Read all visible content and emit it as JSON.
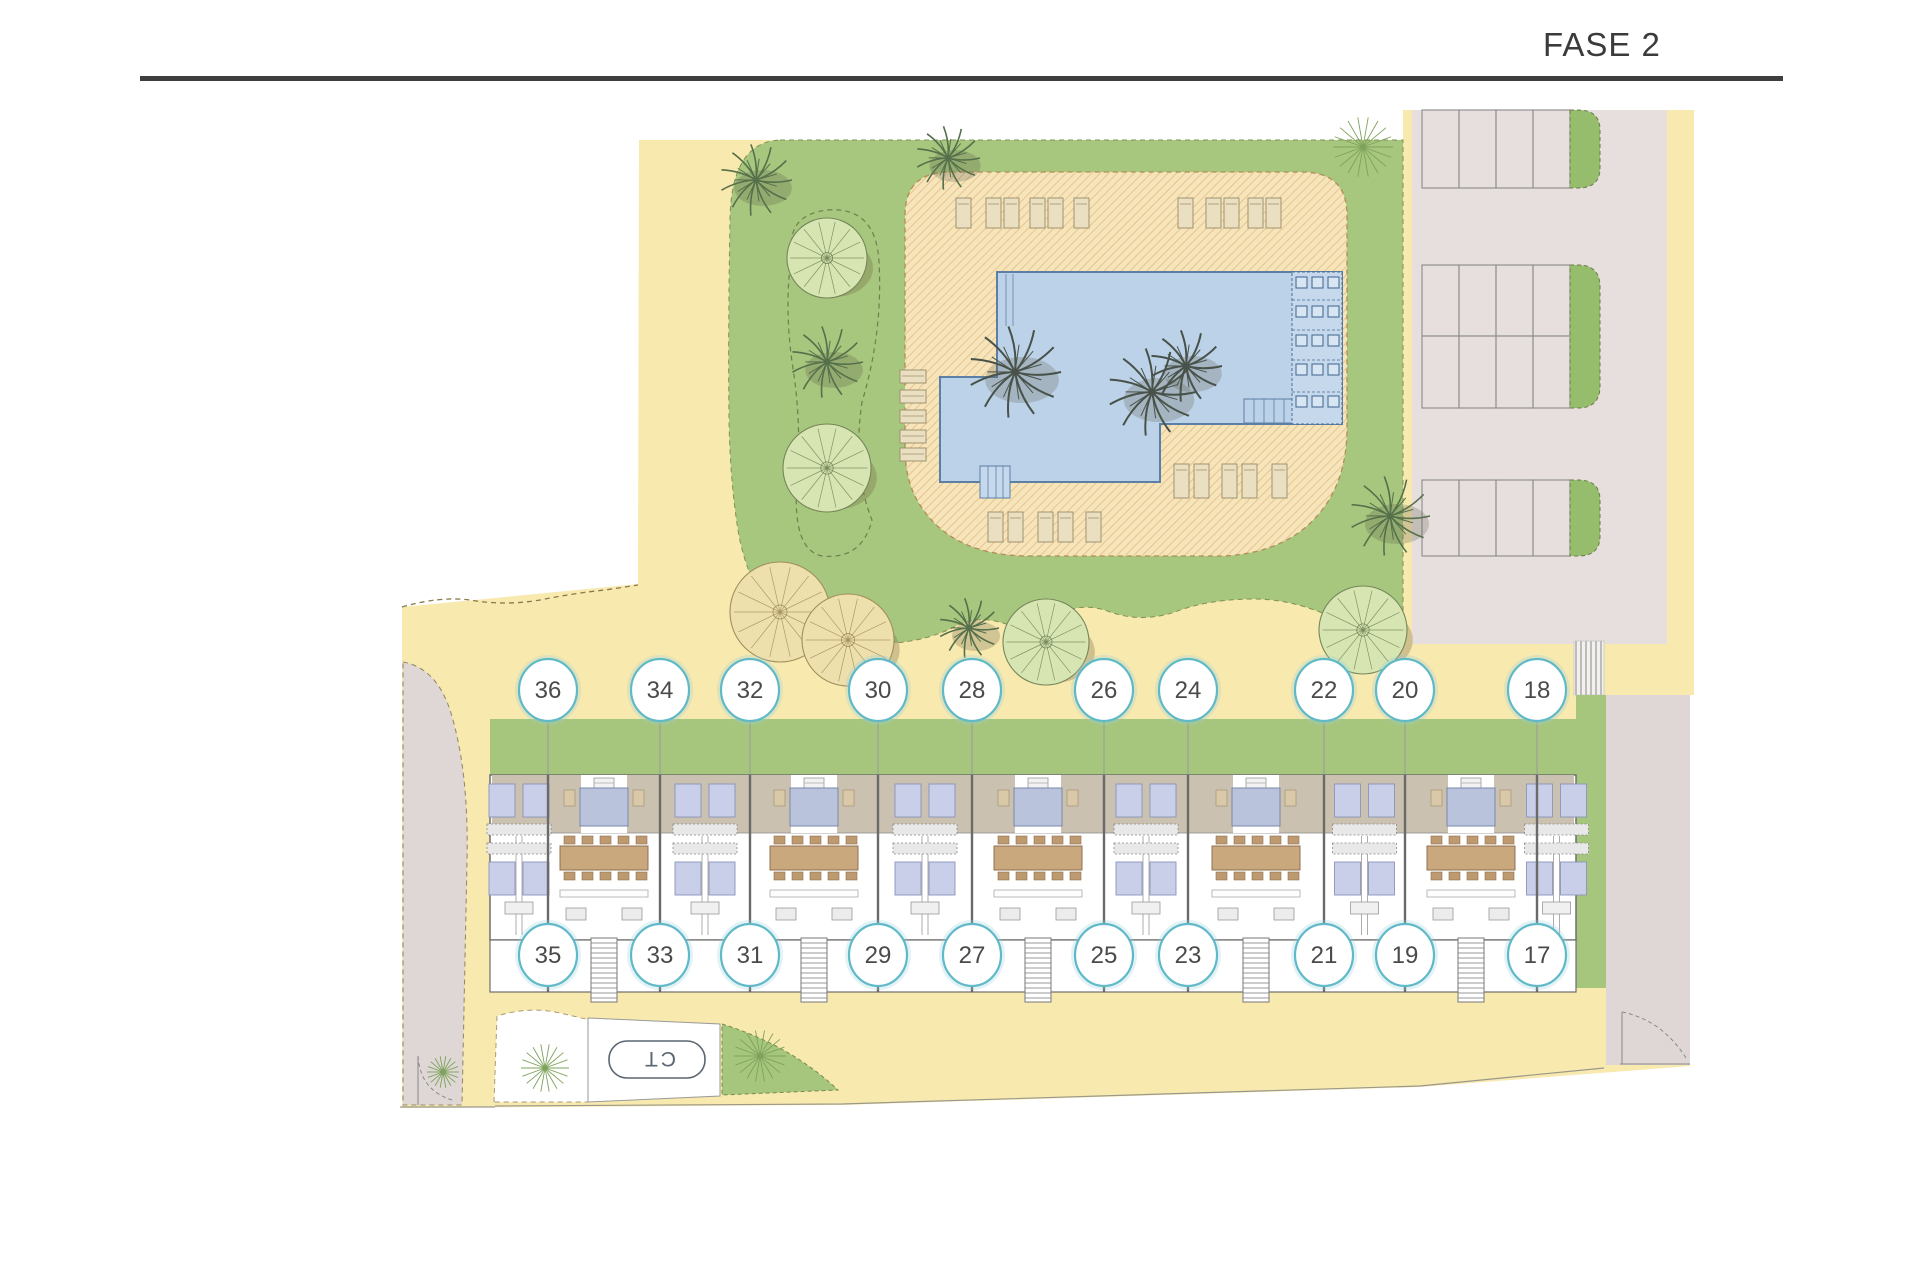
{
  "header": {
    "phase_label": "FASE 2"
  },
  "plan": {
    "ct_label": "CT",
    "unit_rows": {
      "top": [
        "36",
        "34",
        "32",
        "30",
        "28",
        "26",
        "24",
        "22",
        "20",
        "18"
      ],
      "bottom": [
        "35",
        "33",
        "31",
        "29",
        "27",
        "25",
        "23",
        "21",
        "19",
        "17"
      ]
    },
    "units": [
      {
        "top": "36",
        "bottom": "35",
        "cx": 548
      },
      {
        "top": "34",
        "bottom": "33",
        "cx": 660
      },
      {
        "top": "32",
        "bottom": "31",
        "cx": 750
      },
      {
        "top": "30",
        "bottom": "29",
        "cx": 878
      },
      {
        "top": "28",
        "bottom": "27",
        "cx": 972
      },
      {
        "top": "26",
        "bottom": "25",
        "cx": 1104
      },
      {
        "top": "24",
        "bottom": "23",
        "cx": 1188
      },
      {
        "top": "22",
        "bottom": "21",
        "cx": 1324
      },
      {
        "top": "20",
        "bottom": "19",
        "cx": 1405
      },
      {
        "top": "18",
        "bottom": "17",
        "cx": 1537
      }
    ],
    "circle_rows": {
      "top_y": 690,
      "bottom_y": 955
    },
    "colors": {
      "sand": "#f8e9af",
      "grass": "#a6c67e",
      "deck": "#f6e4bb",
      "deck_hatch": "#e5be85",
      "pool": "#bcd2e8",
      "pool_line": "#5b7fa5",
      "parking": "#e6dfde",
      "grey_area": "#ded7d5",
      "roof": "#cac1b0",
      "circle_ring": "#5fb9c8",
      "ink": "#3e3e3e"
    }
  }
}
